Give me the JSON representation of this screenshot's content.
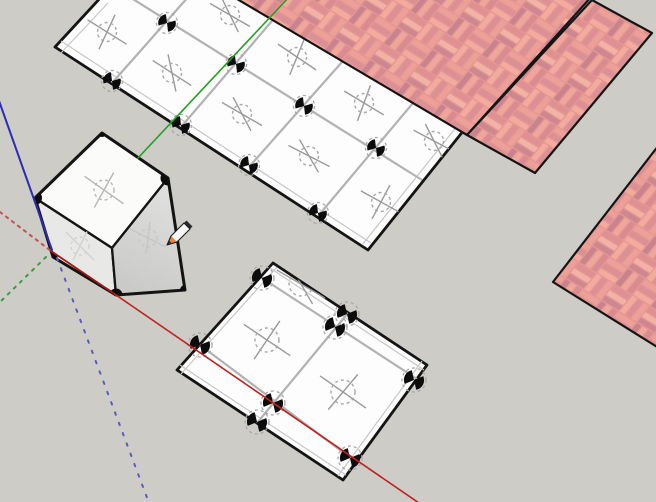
{
  "viewport": {
    "width": 656,
    "height": 502,
    "background": "#cdccc7",
    "edge_color": "#141414",
    "grid_color": "#b2b2b2",
    "inset_color": "#c7c7c7",
    "marker_line_color": "#9a9a9a",
    "marker_circle_color": "#a8a8a8",
    "tile_fill": "#fdfdfd"
  },
  "tile_planes": [
    {
      "name": "top-tile-plane",
      "polygon": [
        [
          55,
          47
        ],
        [
          103,
          -5
        ],
        [
          232,
          -5
        ],
        [
          464,
          130
        ],
        [
          368,
          250
        ]
      ],
      "grid": [
        [
          128,
          -4,
          422,
          180
        ],
        [
          112,
          83,
          189,
          -4
        ],
        [
          181,
          127,
          272,
          21
        ],
        [
          249,
          167,
          342,
          62
        ],
        [
          319,
          215,
          413,
          103
        ]
      ],
      "insets": [
        [
          61,
          41,
          371,
          243
        ],
        [
          61,
          53,
          108,
          3
        ],
        [
          458,
          125,
          362,
          245
        ]
      ],
      "bowties": [
        [
          112,
          81
        ],
        [
          181,
          125
        ],
        [
          249,
          165
        ],
        [
          318,
          213
        ],
        [
          167,
          23
        ],
        [
          236,
          64
        ],
        [
          304,
          106
        ],
        [
          376,
          148
        ]
      ],
      "bowtie_rot": 18,
      "bowtie_r": 8.6,
      "ring_r": 10.5,
      "cross_L1": 23,
      "cross_L2": 19,
      "circle_r": 9.5,
      "crosshairs": [
        [
          107,
          32,
          32,
          -65
        ],
        [
          172,
          73,
          33,
          78
        ],
        [
          242,
          114,
          30,
          62
        ],
        [
          309,
          156,
          27,
          60
        ],
        [
          381,
          202,
          29,
          -62
        ],
        [
          230,
          15,
          30,
          64
        ],
        [
          297,
          57,
          34,
          -68
        ],
        [
          364,
          103,
          31,
          -70
        ],
        [
          434,
          141,
          28,
          63
        ]
      ]
    },
    {
      "name": "bottom-tile-plane",
      "polygon": [
        [
          273,
          263
        ],
        [
          427,
          365
        ],
        [
          343,
          480
        ],
        [
          177,
          370
        ]
      ],
      "grid": [
        [
          262,
          278,
          417,
          379
        ],
        [
          200,
          345,
          356,
          462
        ],
        [
          257,
          423,
          348,
          313
        ]
      ],
      "insets": [
        [
          181,
          374,
          277,
          267
        ],
        [
          270,
          268,
          424,
          370
        ],
        [
          422,
          361,
          338,
          476
        ],
        [
          346,
          475,
          180,
          365
        ]
      ],
      "bowties": [
        [
          262,
          278
        ],
        [
          200,
          345
        ],
        [
          335,
          327
        ],
        [
          273,
          403
        ],
        [
          350,
          458
        ],
        [
          414,
          380
        ],
        [
          257,
          422
        ],
        [
          347,
          314
        ]
      ],
      "bowtie_rot": 12,
      "bowtie_r": 9.8,
      "ring_r": 12,
      "cross_L1": 28,
      "cross_L2": 23,
      "circle_r": 12,
      "crosshairs": [
        [
          267,
          340,
          34,
          -56
        ],
        [
          343,
          392,
          35,
          -50
        ],
        [
          301,
          284,
          30,
          60
        ],
        [
          405,
          447,
          30,
          -60
        ]
      ]
    }
  ],
  "brick": {
    "base": "#e59792",
    "bar_colors": [
      "#f3ab9e",
      "#db9095",
      "#eda098",
      "#ce8791",
      "#f2b3a6",
      "#df9092",
      "#c9838f",
      "#f0a79b",
      "#d88b90"
    ],
    "transform": "matrix(0.89,0.55,0.67,-0.81,450,60)",
    "stroke_width": 2.2,
    "planes": [
      {
        "name": "brick-plane-left",
        "points": [
          [
            232,
            -4
          ],
          [
            467,
            135
          ],
          [
            592,
            -4
          ]
        ]
      },
      {
        "name": "brick-plane-right",
        "points": [
          [
            467,
            135
          ],
          [
            535,
            173
          ],
          [
            652,
            33
          ],
          [
            592,
            0
          ]
        ]
      },
      {
        "name": "brick-plane-corner",
        "points": [
          [
            553,
            282
          ],
          [
            662,
            141
          ],
          [
            662,
            350
          ]
        ]
      }
    ]
  },
  "cube": {
    "name": "cube",
    "silhouette": [
      [
        102,
        133
      ],
      [
        168,
        178
      ],
      [
        185,
        290
      ],
      [
        116,
        295
      ],
      [
        53,
        257
      ],
      [
        35,
        198
      ]
    ],
    "faces": [
      {
        "name": "cube-top-face",
        "points": [
          [
            102,
            133
          ],
          [
            168,
            178
          ],
          [
            112,
            248
          ],
          [
            35,
            198
          ]
        ],
        "fill": "#fbfbfa"
      },
      {
        "name": "cube-left-face",
        "points": [
          [
            35,
            198
          ],
          [
            112,
            248
          ],
          [
            116,
            295
          ],
          [
            53,
            257
          ]
        ],
        "fill": "#e8e8e6"
      },
      {
        "name": "cube-right-face",
        "points": [
          [
            112,
            248
          ],
          [
            168,
            178
          ],
          [
            185,
            290
          ],
          [
            116,
            295
          ]
        ],
        "fill": "url(#rightGrad)"
      }
    ],
    "right_gradient": {
      "x1": 170,
      "y1": 195,
      "x2": 120,
      "y2": 300,
      "c1": "#dededd",
      "c2": "#c7c7c6"
    },
    "markers": [
      {
        "x": 104,
        "y": 190,
        "a1": 35,
        "a2": -61,
        "L1": 24,
        "L2": 20,
        "r": 10,
        "color": "#b7b7b7"
      },
      {
        "x": 80,
        "y": 246,
        "a1": 45,
        "a2": -64,
        "L1": 20,
        "L2": 16,
        "r": 9,
        "color": "#d2d2d2"
      },
      {
        "x": 148,
        "y": 238,
        "a1": 27,
        "a2": -83,
        "L1": 20,
        "L2": 16,
        "r": 9,
        "color": "#c6c6c6"
      }
    ],
    "corner_dots": [
      [
        35,
        198,
        7
      ],
      [
        168,
        178,
        7.5
      ],
      [
        116,
        295,
        6.5
      ],
      [
        185,
        290,
        5
      ],
      [
        102,
        133,
        4
      ],
      [
        53,
        257,
        4.5
      ]
    ]
  },
  "axes": {
    "red_dotted": {
      "x1": 0,
      "y1": 212,
      "x2": 51,
      "y2": 251,
      "color": "#c4524e",
      "w": 2,
      "dash": "2.5 5"
    },
    "red_solid_base": {
      "x1": 51,
      "y1": 251,
      "x2": 116,
      "y2": 295,
      "color": "#a51815",
      "w": 1.8,
      "dash": ""
    },
    "red_solid": {
      "x1": 116,
      "y1": 295,
      "x2": 419,
      "y2": 503,
      "color": "#c0211d",
      "w": 1.6,
      "dash": ""
    },
    "green_solid": {
      "x1": 138,
      "y1": 158,
      "x2": 290,
      "y2": -4,
      "color": "#22a022",
      "w": 1.6,
      "dash": ""
    },
    "green_dotted": {
      "x1": 46,
      "y1": 257,
      "x2": -2,
      "y2": 304,
      "color": "#3f9b3f",
      "w": 2,
      "dash": "2.5 6"
    },
    "blue_solid": {
      "x1": -2,
      "y1": 98,
      "x2": 52,
      "y2": 250,
      "color": "#2b2bb4",
      "w": 2,
      "dash": ""
    },
    "blue_dotted": {
      "x1": 57,
      "y1": 258,
      "x2": 149,
      "y2": 503,
      "color": "#5b5bc0",
      "w": 2,
      "dash": "2.5 8.5"
    }
  },
  "cursor": {
    "name": "pencil-tool-cursor",
    "body": [
      [
        171,
        236
      ],
      [
        184,
        223
      ],
      [
        190,
        229
      ],
      [
        177,
        242
      ]
    ],
    "wood": [
      [
        167,
        245
      ],
      [
        171,
        236
      ],
      [
        177,
        242
      ]
    ],
    "tip": [
      [
        167,
        245
      ],
      [
        169.3,
        240.8
      ],
      [
        171.4,
        242.9
      ]
    ],
    "cap": [
      [
        184,
        223
      ],
      [
        186.5,
        220.5
      ],
      [
        192.5,
        226.5
      ],
      [
        190,
        229
      ]
    ],
    "outline": [
      [
        167,
        245
      ],
      [
        171,
        236
      ],
      [
        184,
        223
      ],
      [
        190,
        229
      ],
      [
        177,
        242
      ]
    ],
    "body_fill": "#f8f8f8",
    "wood_fill": "#e8823c",
    "tip_fill": "#333333",
    "cap_fill": "#2a2a2a",
    "stroke": "#1c1c1c"
  }
}
